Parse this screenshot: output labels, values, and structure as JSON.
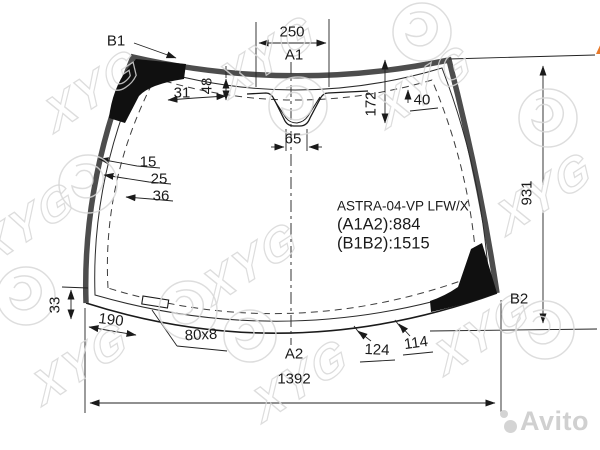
{
  "part": {
    "model_code": "ASTRA-04-VP LFW/X",
    "diagonal_a1a2": "(A1A2):884",
    "diagonal_b1b2": "(B1B2):1515"
  },
  "points": {
    "a1": "A1",
    "a2": "A2",
    "b1": "B1",
    "b2": "B2"
  },
  "dimensions": {
    "top_width": "250",
    "corner_band_31": "31",
    "band_depth_48": "48",
    "center_depth_172": "172",
    "band_width_right_40": "40",
    "mount_width_65": "65",
    "left_edge_offsets": [
      "15",
      "25",
      "36"
    ],
    "right_height_931": "931",
    "bottom_step_33": "33",
    "bottom_offset_190": "190",
    "bottom_rect_size": "80x8",
    "bottom_mark_124": "124",
    "bottom_mark_114": "114",
    "bottom_width_1392": "1392"
  },
  "branding": {
    "at_logo_a": "A",
    "at_logo_t": "T",
    "at_orange": "#e8792a",
    "at_blue": "#20409a",
    "glass_maker_watermark": "XYG",
    "photo_watermark": "Avito",
    "watermark_gray": "#d6d6d6",
    "line_color": "#1a1a1a",
    "band_color": "#4d4d4d"
  }
}
